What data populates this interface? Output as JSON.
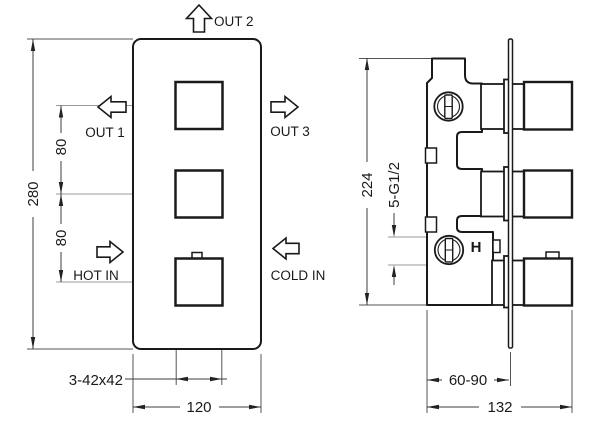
{
  "front_view": {
    "flows": {
      "out1": "OUT 1",
      "out2": "OUT 2",
      "out3": "OUT 3",
      "hot_in": "HOT IN",
      "cold_in": "COLD IN"
    },
    "dims": {
      "overall_height": "280",
      "spacing_upper": "80",
      "spacing_lower": "80",
      "handle_size": "3-42x42",
      "overall_width": "120"
    }
  },
  "side_view": {
    "dims": {
      "overall_height": "224",
      "connections": "5-G1/2",
      "install_depth": "60-90",
      "overall_depth": "132"
    },
    "hot_mark": "H"
  },
  "colors": {
    "object_line": "#1a1a1a",
    "dimension_line": "#3d3d3d",
    "centerline": "#999999",
    "background": "#ffffff"
  }
}
